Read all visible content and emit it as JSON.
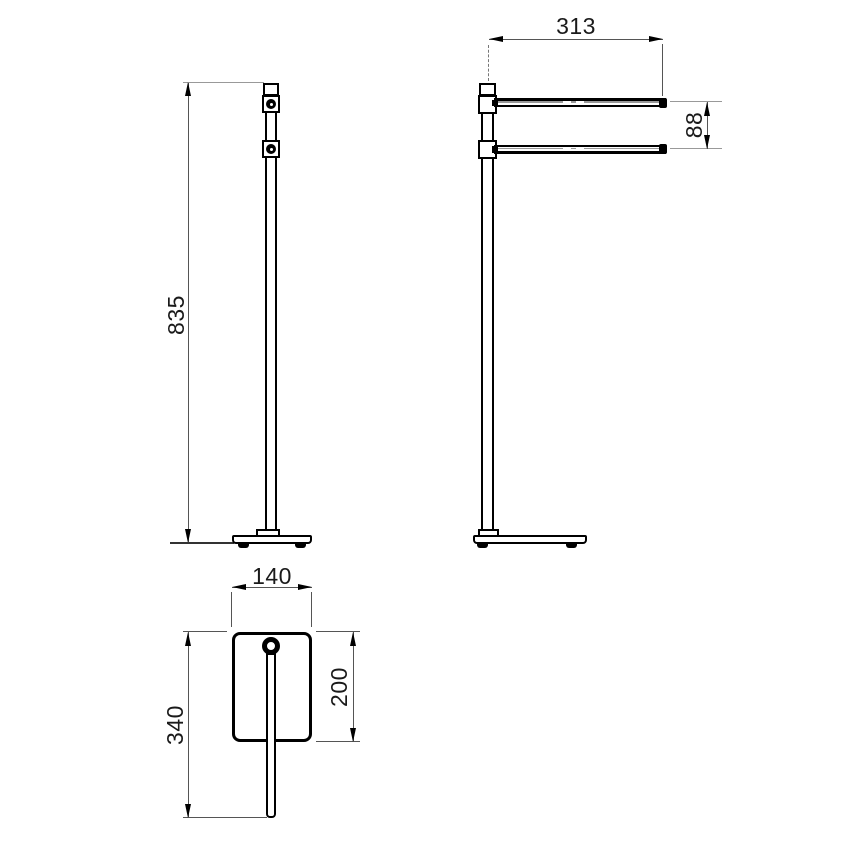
{
  "dimensions": {
    "front_height": "835",
    "arm_length": "313",
    "arm_spacing": "88",
    "base_width": "140",
    "base_depth": "200",
    "overall_depth": "340"
  },
  "colors": {
    "background": "#ffffff",
    "object_lines": "#000000",
    "dimension_lines": "#666666",
    "extension_lines": "#999999",
    "labels": "#1a1a1a"
  }
}
